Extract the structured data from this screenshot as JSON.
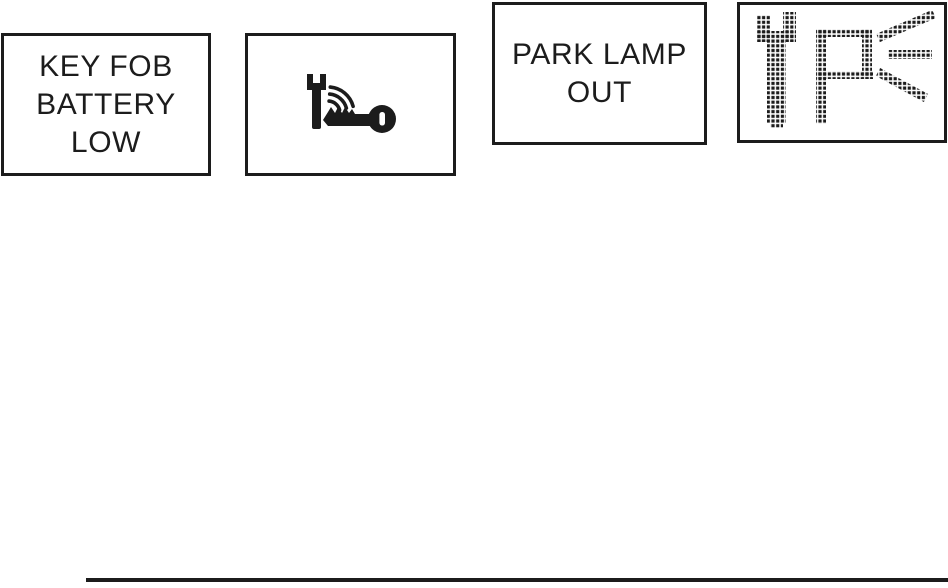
{
  "colors": {
    "ink": "#1c1c1c",
    "background": "#ffffff"
  },
  "figures": {
    "key_fob_message": {
      "lines": [
        "KEY FOB",
        "BATTERY",
        "LOW"
      ]
    },
    "key_fob_symbol": {
      "icon": "wrench-key-signal-icon"
    },
    "park_lamp_message": {
      "lines": [
        "PARK LAMP",
        "OUT"
      ]
    },
    "park_lamp_symbol": {
      "icon": "wrench-park-lamp-rays-dot-matrix-icon"
    }
  }
}
